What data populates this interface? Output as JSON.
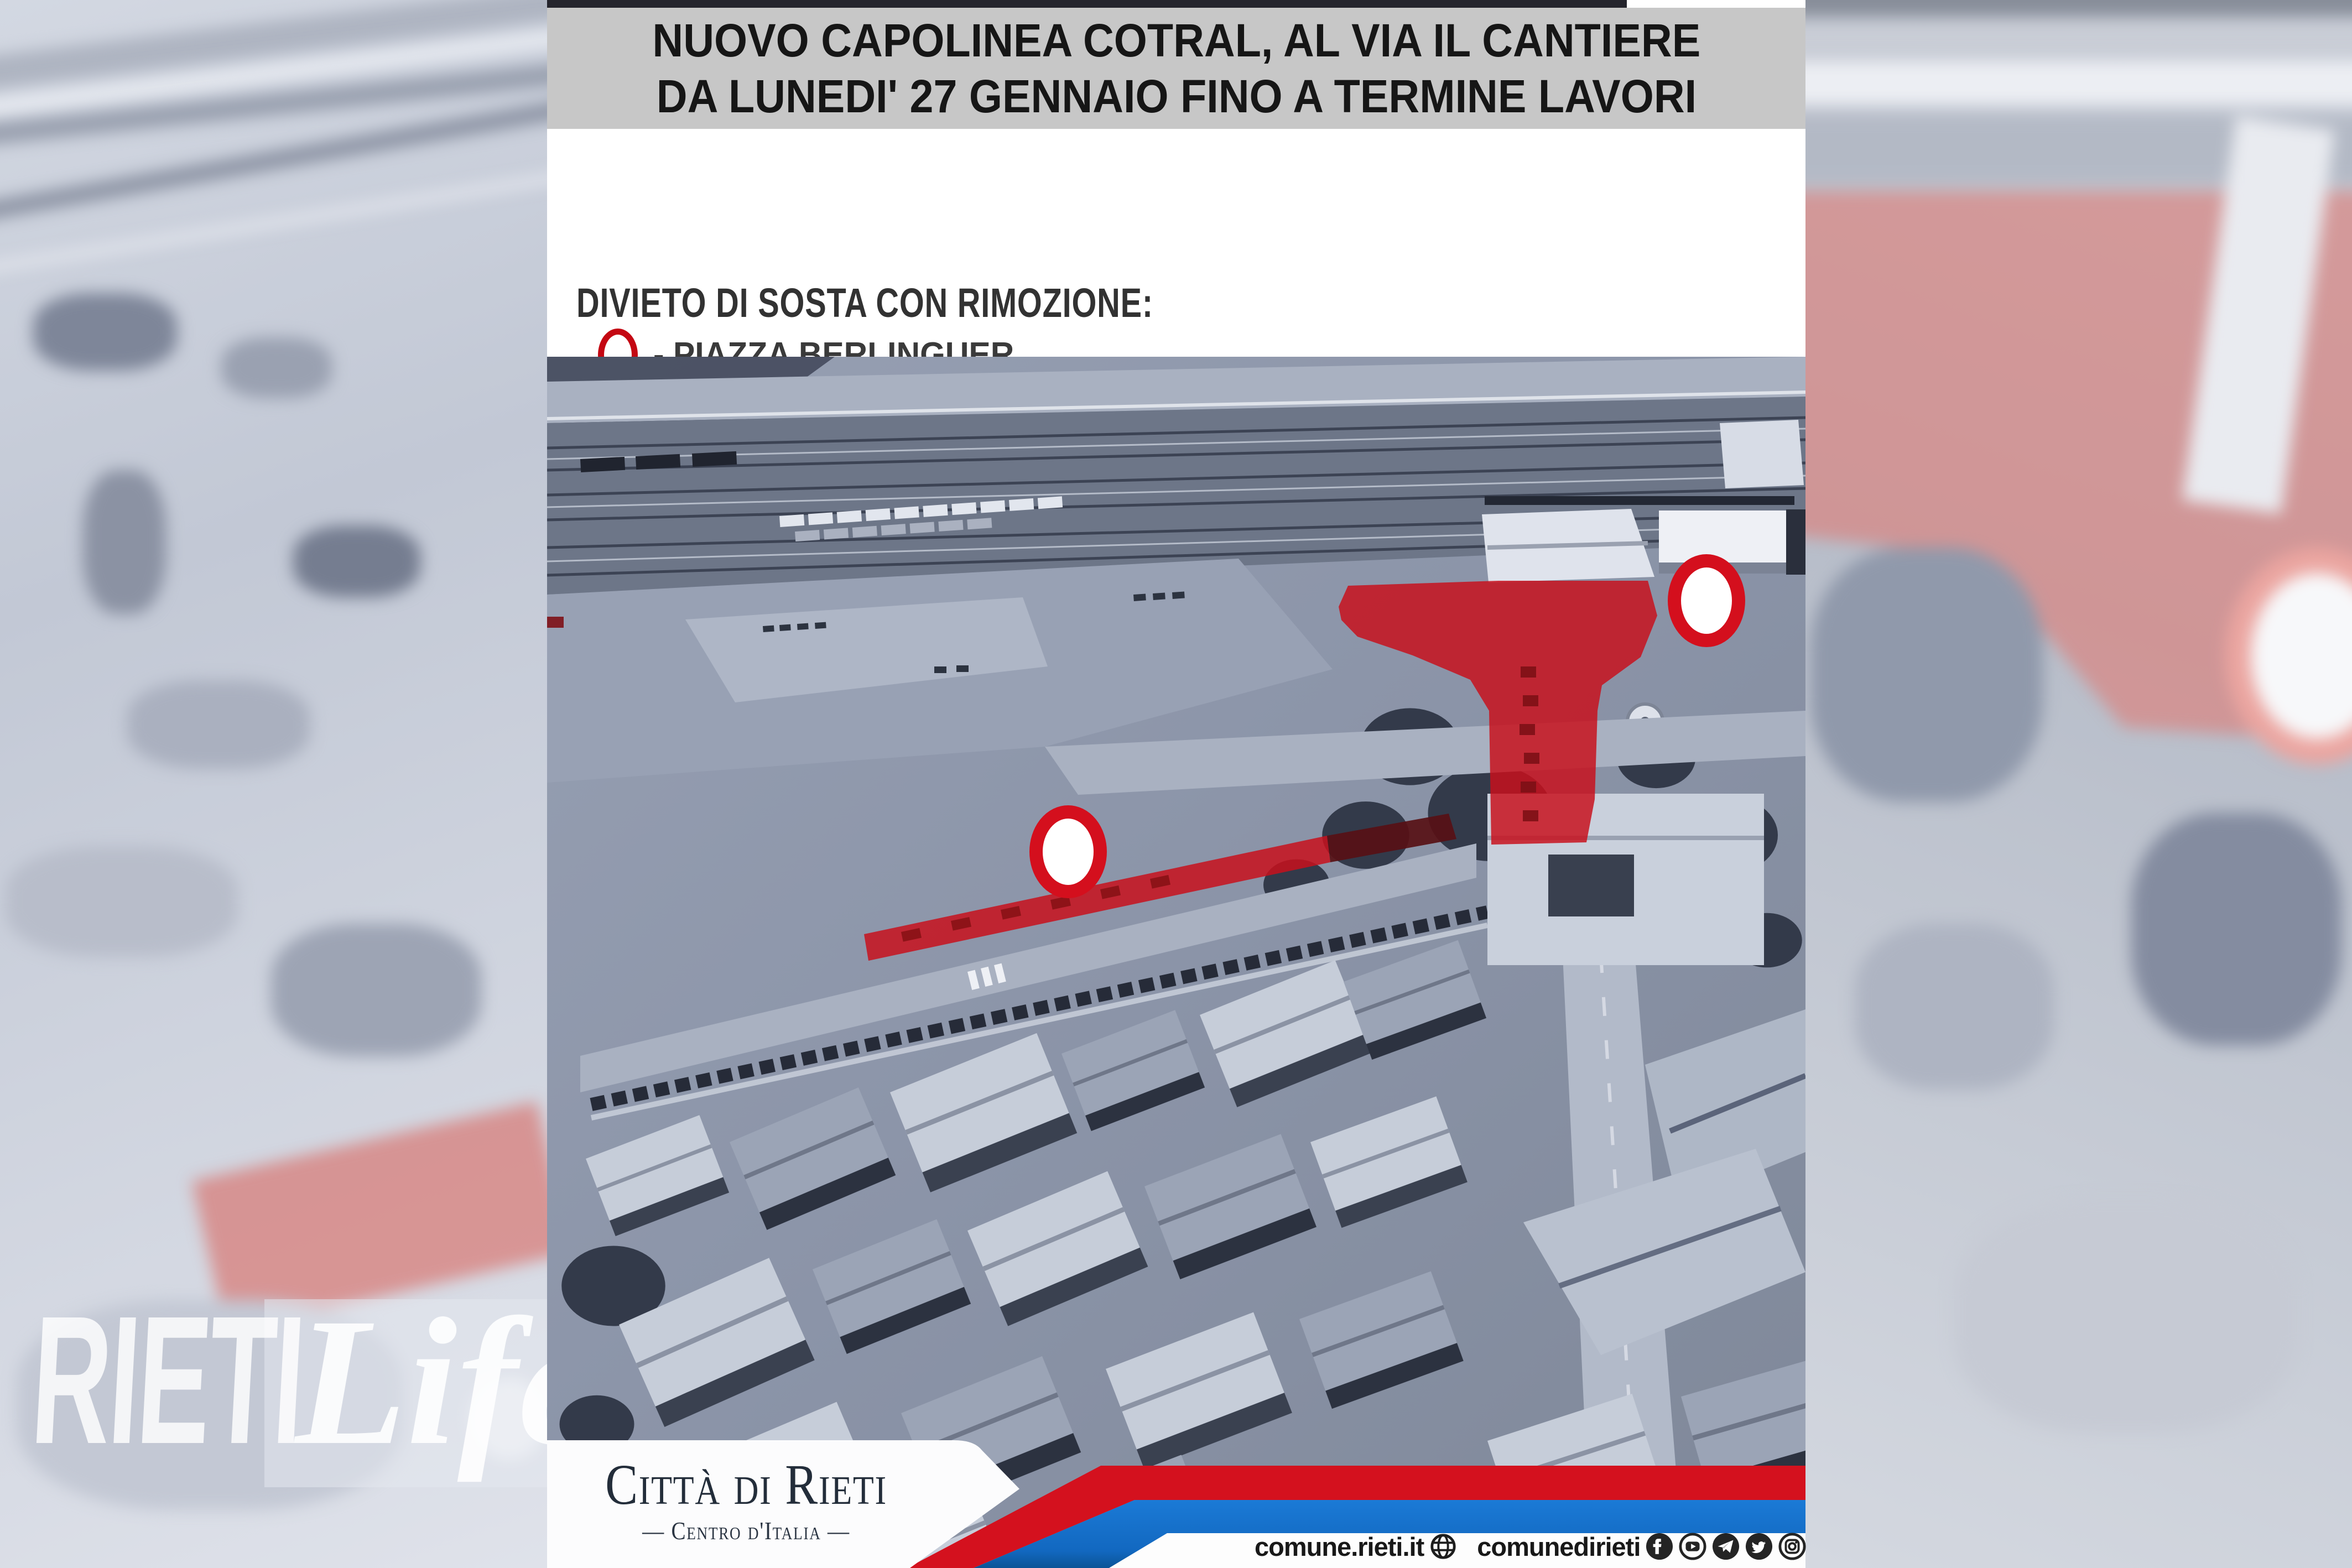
{
  "poster": {
    "alert": {
      "line1": "NUOVO CAPOLINEA COTRAL, AL VIA IL CANTIERE",
      "line2": "DA LUNEDI' 27 GENNAIO FINO A TERMINE LAVORI"
    },
    "notice": {
      "title": "DIVIETO DI SOSTA CON RIMOZIONE:",
      "items": [
        "- PIAZZA BERLINGUER",
        "- VIA CANALI (TRATTO PIAZZA MAZZINI FINO AL CIVICO 17/A)",
        "- FRONTE INGRESSO CAPOLINEA COTRAL"
      ]
    },
    "map": {
      "marker_icons": [
        "map-marker-piazza-berlinguer",
        "map-marker-via-canali"
      ],
      "overlay_icons": [
        "no-parking-area-piazza-berlinguer",
        "no-parking-strip-via-canali"
      ]
    },
    "footer": {
      "logo_title": "Città di Rieti",
      "logo_subtitle": "— Centro d'Italia —",
      "website": "comune.rieti.it",
      "social_handle": "comunedirieti",
      "social_icons": [
        "globe-icon",
        "facebook-icon",
        "youtube-icon",
        "telegram-icon",
        "twitter-icon",
        "instagram-icon"
      ]
    },
    "colors": {
      "header_band": "#c7c7c7",
      "top_strip": "#24242c",
      "stripe_red": "#d4111e",
      "stripe_blue": "#1470cf",
      "marker_ring_red": "#d40f1d",
      "overlay_red": "#c8101c",
      "bullet_text": "#3a3a3a"
    }
  },
  "watermark": {
    "brand": "RIETI",
    "brand2": "Life"
  }
}
